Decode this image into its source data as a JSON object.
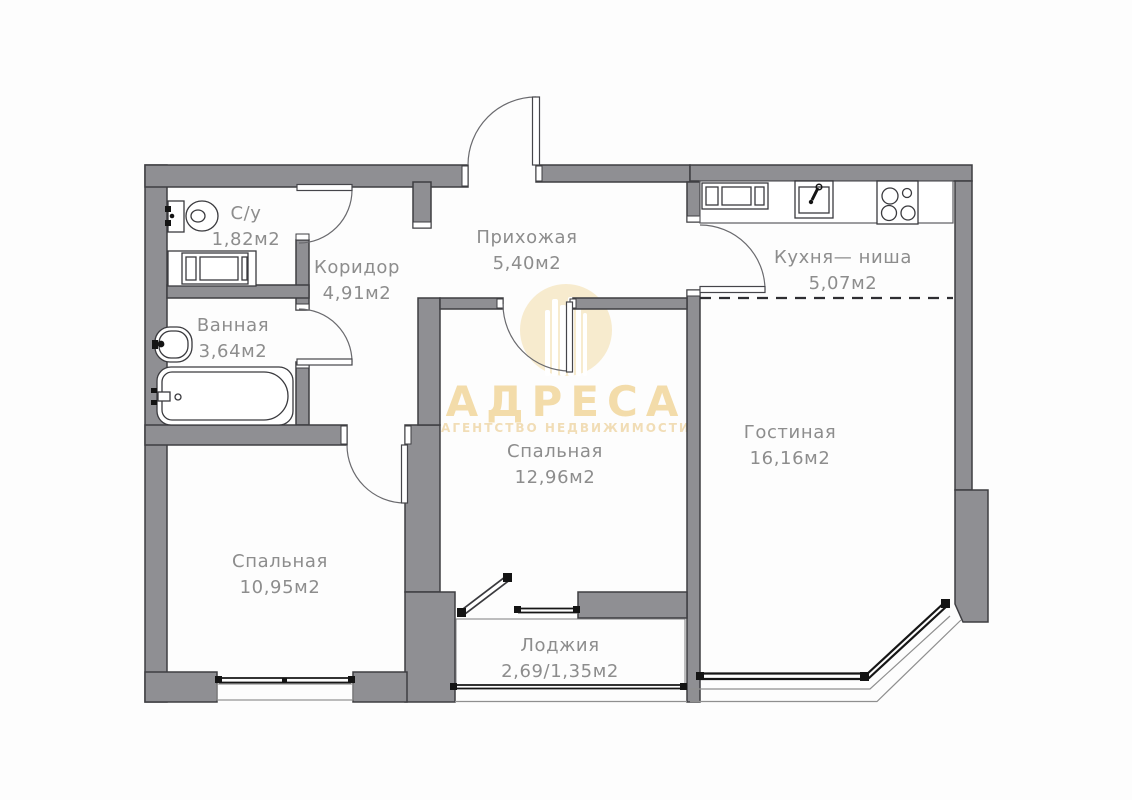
{
  "watermark": {
    "title": "АДРЕСА",
    "subtitle": "АГЕНТСТВО НЕДВИЖИМОСТИ",
    "logo_icon": "building-columns-logo-icon"
  },
  "rooms": [
    {
      "id": "toilet",
      "name": "С/у",
      "area": "1,82м2"
    },
    {
      "id": "corridor",
      "name": "Коридор",
      "area": "4,91м2"
    },
    {
      "id": "hallway",
      "name": "Прихожая",
      "area": "5,40м2"
    },
    {
      "id": "kitchen-niche",
      "name": "Кухня— ниша",
      "area": "5,07м2"
    },
    {
      "id": "bathroom",
      "name": "Ванная",
      "area": "3,64м2"
    },
    {
      "id": "bedroom-middle",
      "name": "Спальная",
      "area": "12,96м2"
    },
    {
      "id": "living-room",
      "name": "Гостиная",
      "area": "16,16м2"
    },
    {
      "id": "bedroom-left",
      "name": "Спальная",
      "area": "10,95м2"
    },
    {
      "id": "loggia",
      "name": "Лоджия",
      "area": "2,69/1,35м2"
    }
  ],
  "icons": {
    "toilet": "toilet-icon",
    "bath_washing_machine": "washing-machine-icon",
    "wash_basin": "wash-basin-icon",
    "bathtub": "bathtub-icon",
    "kitchen_washing_machine": "washing-machine-icon",
    "kitchen_sink": "kitchen-sink-icon",
    "stove": "stove-icon"
  },
  "colors": {
    "wall_fill": "#8f8f93",
    "wall_outline": "#3e3e42",
    "label_text": "#8d8d8d",
    "window_line": "#161616",
    "watermark_gold": "#f3dcaa",
    "watermark_gold_light": "#f1ddb6",
    "watermark_circle": "#f7ebce"
  }
}
